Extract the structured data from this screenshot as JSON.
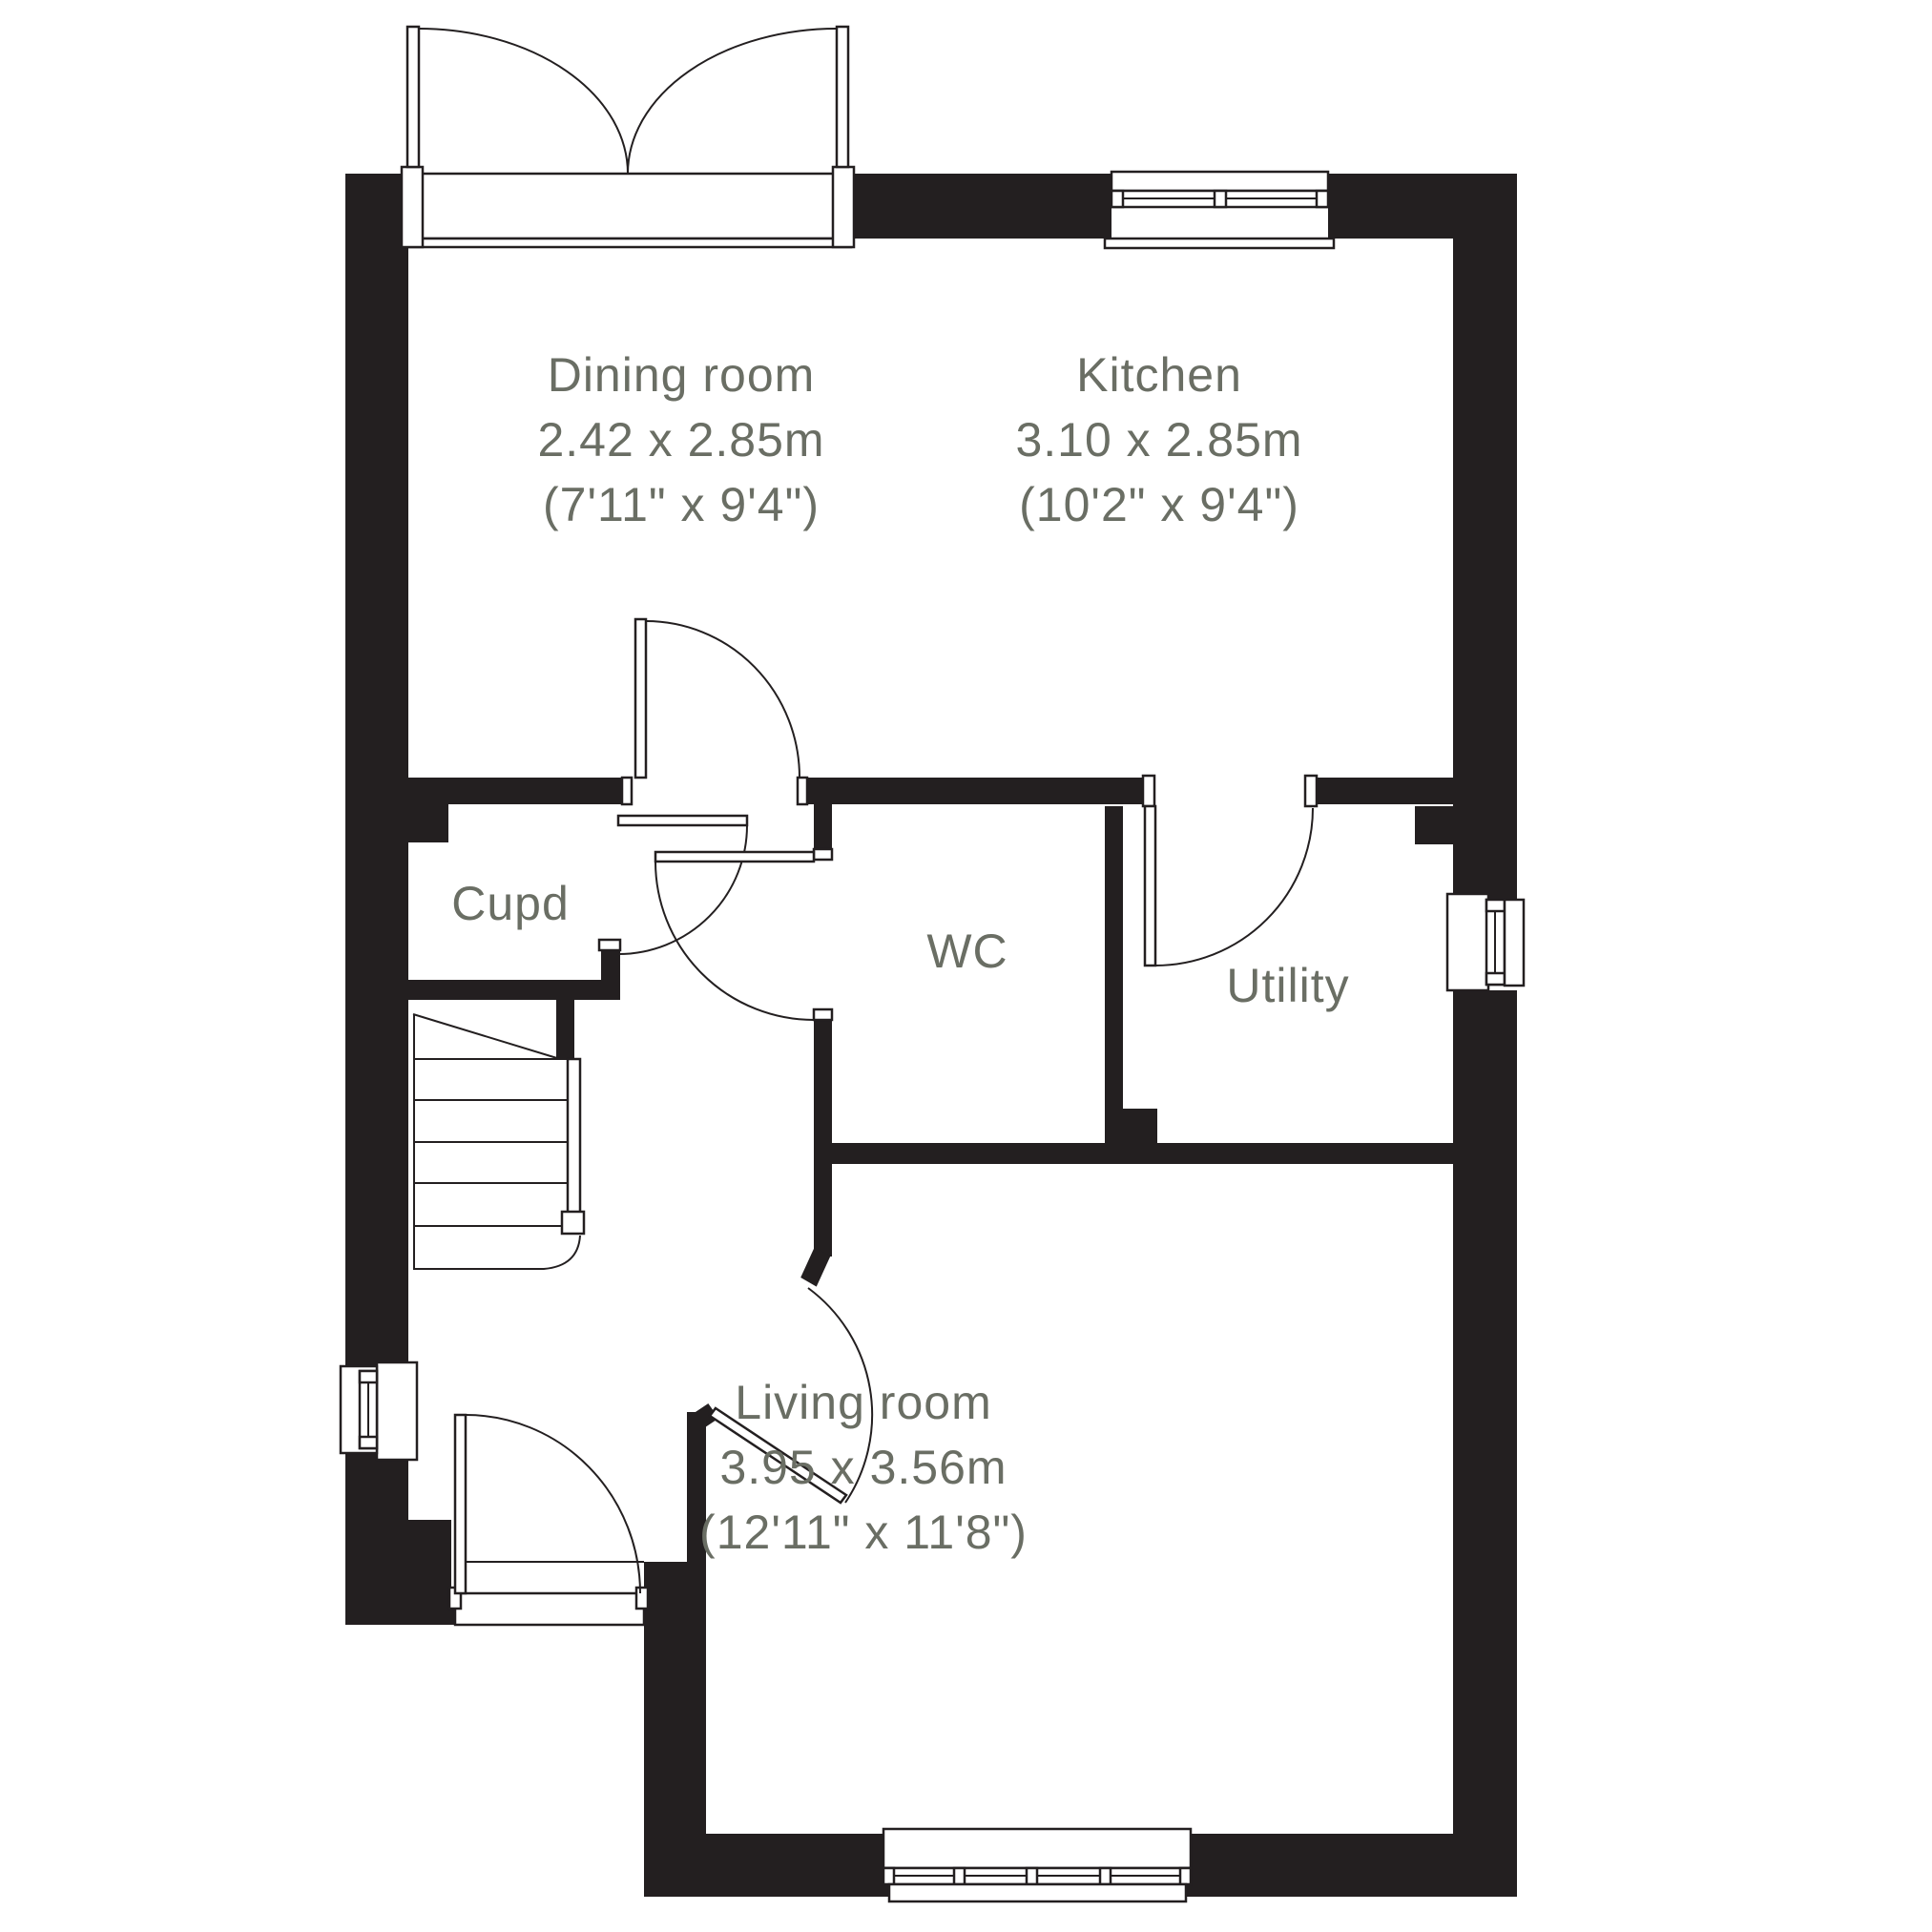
{
  "colors": {
    "wall": "#231f20",
    "line": "#231f20",
    "label": "#6a6e64",
    "background": "#ffffff"
  },
  "rooms": {
    "dining_room": {
      "name": "Dining room",
      "size_metric": "2.42 x 2.85m",
      "size_imperial": "(7'11\" x 9'4\")"
    },
    "kitchen": {
      "name": "Kitchen",
      "size_metric": "3.10 x 2.85m",
      "size_imperial": "(10'2\" x 9'4\")"
    },
    "cupboard": {
      "name": "Cupd"
    },
    "wc": {
      "name": "WC"
    },
    "utility": {
      "name": "Utility"
    },
    "living_room": {
      "name": "Living room",
      "size_metric": "3.95 x 3.56m",
      "size_imperial": "(12'11\" x 11'8\")"
    }
  }
}
